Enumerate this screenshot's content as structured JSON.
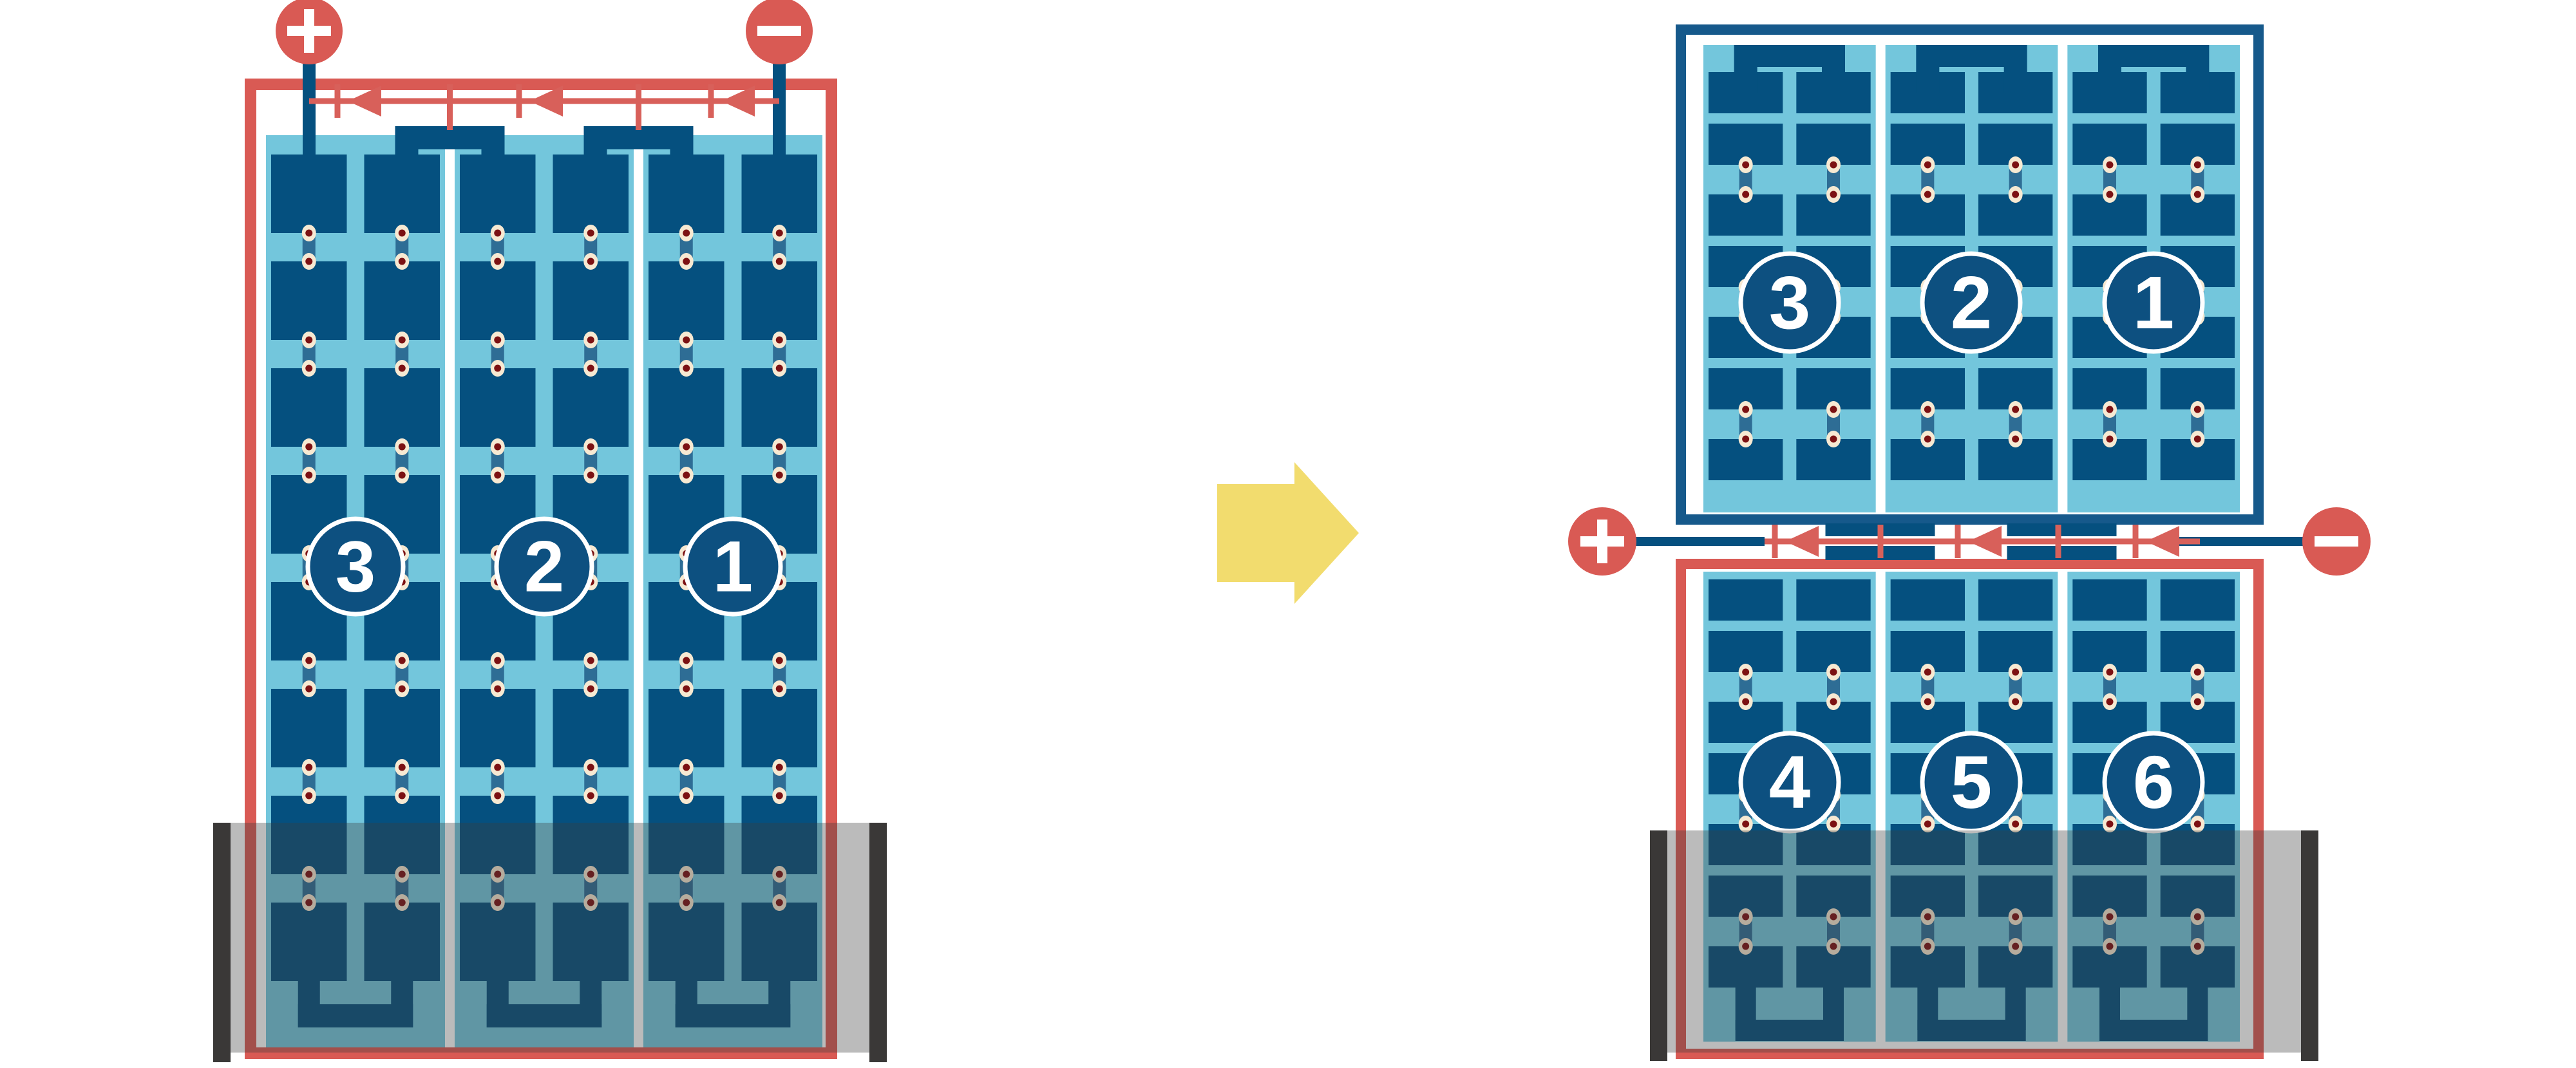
{
  "diagram_type": "pv-panel-series-wiring-before-after",
  "colors": {
    "background": "#ffffff",
    "red": "#d95a54",
    "red_line": "#d8605a",
    "navy_cell": "#05507f",
    "navy_frame_right_top": "#16598b",
    "sky_panel": "#73c6dc",
    "steel_interconnect": "#2e6d95",
    "dot_ring": "#f7e9d2",
    "dot_core": "#7c1113",
    "module_separator": "#ffffff",
    "badge_fill": "#0d5080",
    "badge_stroke": "#ffffff",
    "shade_overlay": "rgba(60,60,60,0.35)",
    "mounting_rail": "#3a3837",
    "arrow_yellow": "#f2dc6e",
    "terminal_symbol": "#ffffff"
  },
  "left_diagram": {
    "terminals": {
      "positive_symbol": "+",
      "negative_symbol": "−"
    },
    "modules": [
      {
        "label": "3"
      },
      {
        "label": "2"
      },
      {
        "label": "1"
      }
    ],
    "bypass_diode_count": 3
  },
  "transform_arrow": {
    "direction": "right"
  },
  "right_diagram": {
    "terminals": {
      "positive_symbol": "+",
      "negative_symbol": "−"
    },
    "top_panel": {
      "modules": [
        {
          "label": "3"
        },
        {
          "label": "2"
        },
        {
          "label": "1"
        }
      ]
    },
    "bottom_panel": {
      "modules": [
        {
          "label": "4"
        },
        {
          "label": "5"
        },
        {
          "label": "6"
        }
      ]
    },
    "bypass_diode_count": 3
  }
}
